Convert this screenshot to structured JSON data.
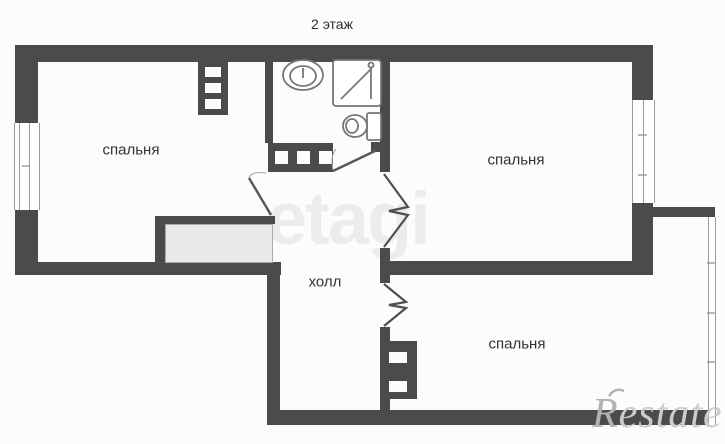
{
  "title": "2 этаж",
  "rooms": {
    "bedroom_left": {
      "label": "спальня"
    },
    "bedroom_top_right": {
      "label": "спальня"
    },
    "hall": {
      "label": "холл"
    },
    "bedroom_bottom_right": {
      "label": "спальня"
    }
  },
  "fixtures": [
    "sink",
    "shower-cabin",
    "toilet",
    "ventilation-shaft",
    "built-in-closet"
  ],
  "watermark": {
    "text": "etagi"
  },
  "logo": {
    "initial": "R",
    "rest": "estate"
  },
  "colors": {
    "wall": "#4b4b4d",
    "bg": "#fcfcfc",
    "fixture": "#76767a",
    "closet-fill": "#e9e9e9",
    "window-line": "#9a9a9c",
    "label": "#333333",
    "watermark": "rgba(80,80,80,0.09)",
    "logo": "#cccccc",
    "logo-initial": "#b2b2b2"
  }
}
